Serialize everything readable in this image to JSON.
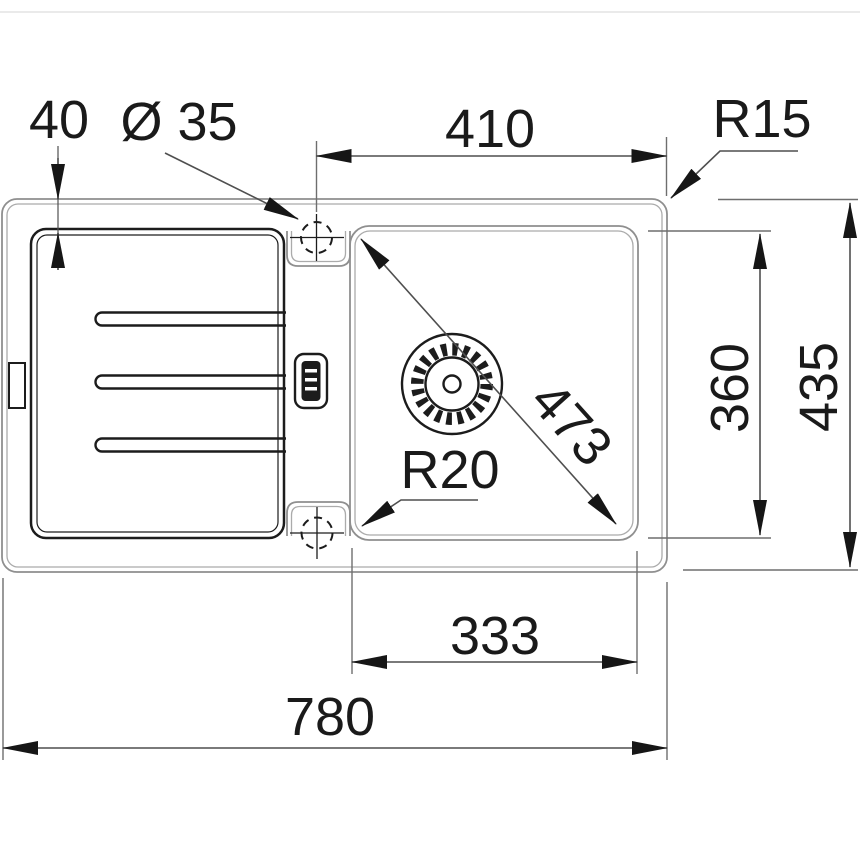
{
  "drawing": {
    "type": "technical-dimension-drawing",
    "subject": "inset kitchen sink with drainboard, top view",
    "units": "mm",
    "dimensions": {
      "rim_to_drainboard_offset": "40",
      "tap_hole_diameter": "Ø 35",
      "top_width": "410",
      "outer_corner_radius": "R15",
      "bowl_depth": "360",
      "overall_depth": "435",
      "bowl_diagonal": "473",
      "bowl_corner_radius": "R20",
      "bowl_width": "333",
      "overall_width": "780"
    },
    "colors": {
      "contour": "#8f8f8f",
      "dimension_lines": "#4f4f4f",
      "ink": "#1a1a1a",
      "background": "#ffffff"
    }
  }
}
